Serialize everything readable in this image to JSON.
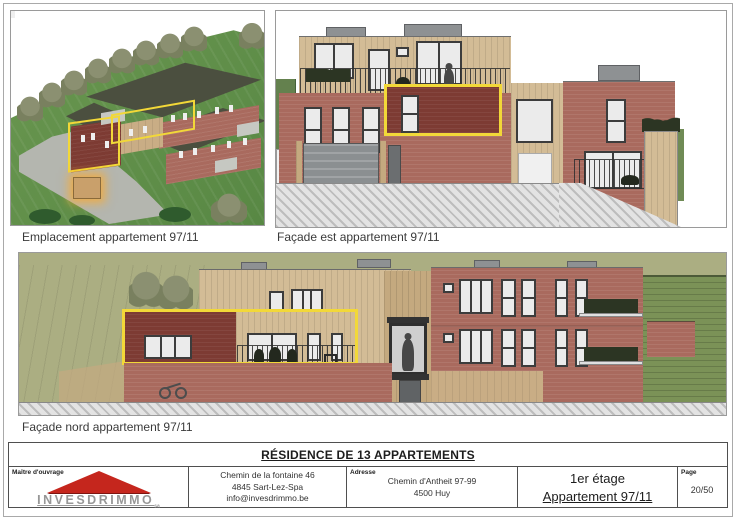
{
  "page": {
    "title": "RÉSIDENCE DE 13 APPARTEMENTS"
  },
  "captions": {
    "location": "Emplacement appartement 97/11",
    "east_facade": "Façade est appartement 97/11",
    "north_facade": "Façade nord appartement 97/11"
  },
  "footer": {
    "maitre_ouvrage_label": "Maître d'ouvrage",
    "logo_text": "INVESDRIMMO",
    "logo_suffix": "sa",
    "contact_line1": "Chemin de la fontaine 46",
    "contact_line2": "4845 Sart-Lez-Spa",
    "contact_line3": "info@invesdrimmo.be",
    "adresse_label": "Adresse",
    "adresse_line1": "Chemin d'Antheit 97-99",
    "adresse_line2": "4500 Huy",
    "floor": "1er étage",
    "apartment": "Appartement 97/11",
    "page_label": "Page",
    "page_value": "20/50"
  },
  "colors": {
    "brick": "#a96a5e",
    "brick-dark": "#7d3b33",
    "wood": "#d3bc96",
    "wood-dark": "#c4a97f",
    "tan-wall": "#c9ad85",
    "highlight": "#f2d838",
    "roof": "#4b4f3f",
    "lawn": "#67944d",
    "sage": "#abae82",
    "green-siding": "#7b9257",
    "logo-red": "#c5261d"
  }
}
